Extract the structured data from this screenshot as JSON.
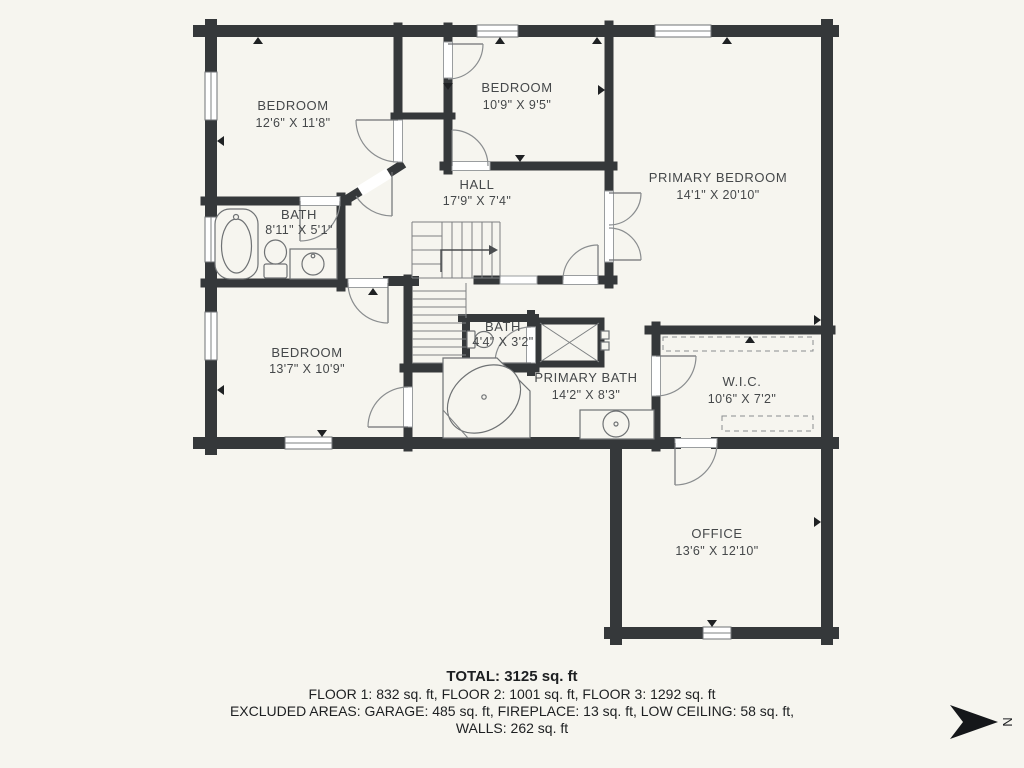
{
  "plan": {
    "rooms": [
      {
        "id": "bedroom-1",
        "name": "BEDROOM",
        "dims": "12'6\" X 11'8\""
      },
      {
        "id": "bedroom-2",
        "name": "BEDROOM",
        "dims": "10'9\" X 9'5\""
      },
      {
        "id": "primary-bedroom",
        "name": "PRIMARY BEDROOM",
        "dims": "14'1\" X 20'10\""
      },
      {
        "id": "hall",
        "name": "HALL",
        "dims": "17'9\" X 7'4\""
      },
      {
        "id": "bath-1",
        "name": "BATH",
        "dims": "8'11\" X 5'1\""
      },
      {
        "id": "bedroom-3",
        "name": "BEDROOM",
        "dims": "13'7\" X 10'9\""
      },
      {
        "id": "bath-2",
        "name": "BATH",
        "dims": "4'4\" X 3'2\""
      },
      {
        "id": "primary-bath",
        "name": "PRIMARY BATH",
        "dims": "14'2\" X 8'3\""
      },
      {
        "id": "wic",
        "name": "W.I.C.",
        "dims": "10'6\" X 7'2\""
      },
      {
        "id": "office",
        "name": "OFFICE",
        "dims": "13'6\" X 12'10\""
      }
    ],
    "summary": {
      "total": "TOTAL: 3125 sq. ft",
      "floors": "FLOOR 1: 832 sq. ft, FLOOR 2: 1001 sq. ft, FLOOR 3: 1292 sq. ft",
      "excluded": "EXCLUDED AREAS: GARAGE: 485 sq. ft, FIREPLACE: 13 sq. ft, LOW CEILING: 58 sq. ft,",
      "walls": "WALLS: 262 sq. ft"
    },
    "compass": {
      "letter": "N"
    },
    "colors": {
      "wall": "#35383a",
      "background": "#f6f5ef",
      "window": "#ffffff"
    }
  }
}
